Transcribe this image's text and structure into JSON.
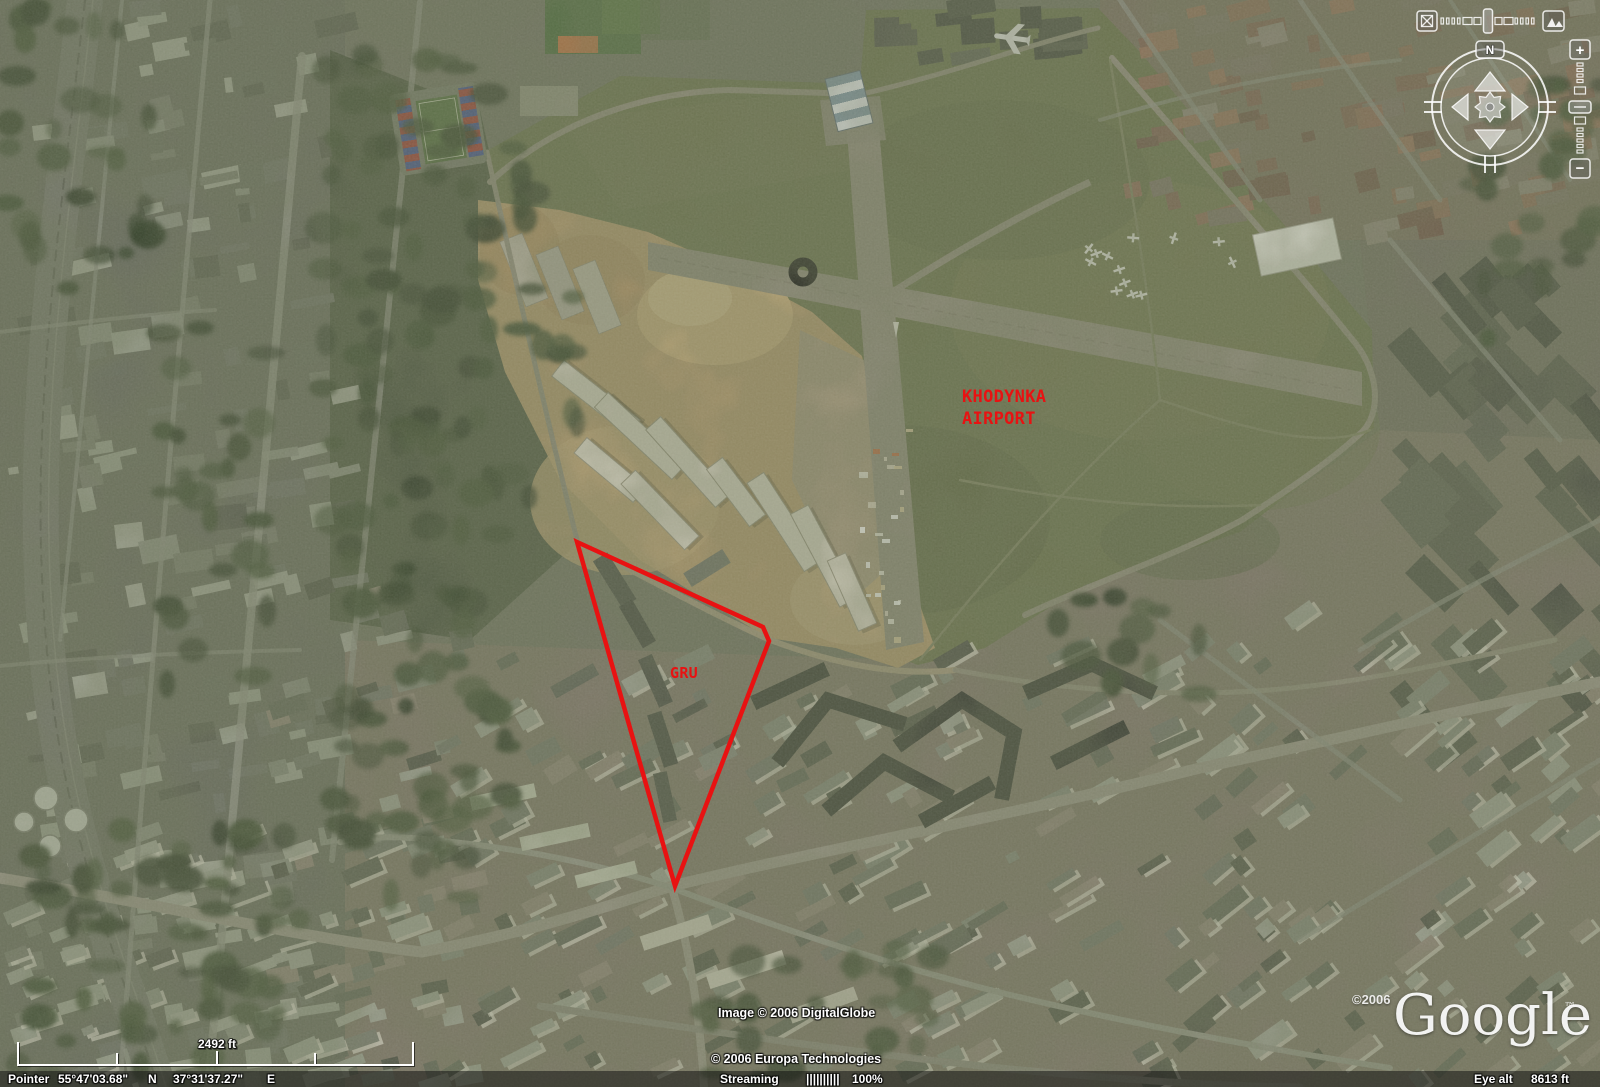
{
  "annotations": {
    "airport_label_line1": "KHODYNKA",
    "airport_label_line2": "AIRPORT",
    "gru_label": "GRU",
    "color": "#e81212"
  },
  "navigation": {
    "north_label": "N",
    "zoom_in_label": "+",
    "zoom_out_label": "−"
  },
  "scale_bar": {
    "distance_label": "2492 ft"
  },
  "watermarks": {
    "image_credit": "Image © 2006 DigitalGlobe",
    "map_credit": "© 2006 Europa Technologies",
    "logo_year": "©2006",
    "logo_text": "Google",
    "logo_tm": "™"
  },
  "status_bar": {
    "pointer_label": "Pointer",
    "latitude": "55°47'03.68\"",
    "lat_hemisphere": "N",
    "longitude": "37°31'37.27\"",
    "lon_hemisphere": "E",
    "streaming_label": "Streaming",
    "streaming_bars": "||||||||||",
    "streaming_percent": "100%",
    "eye_alt_label": "Eye alt",
    "eye_alt_value": "8613 ft"
  }
}
